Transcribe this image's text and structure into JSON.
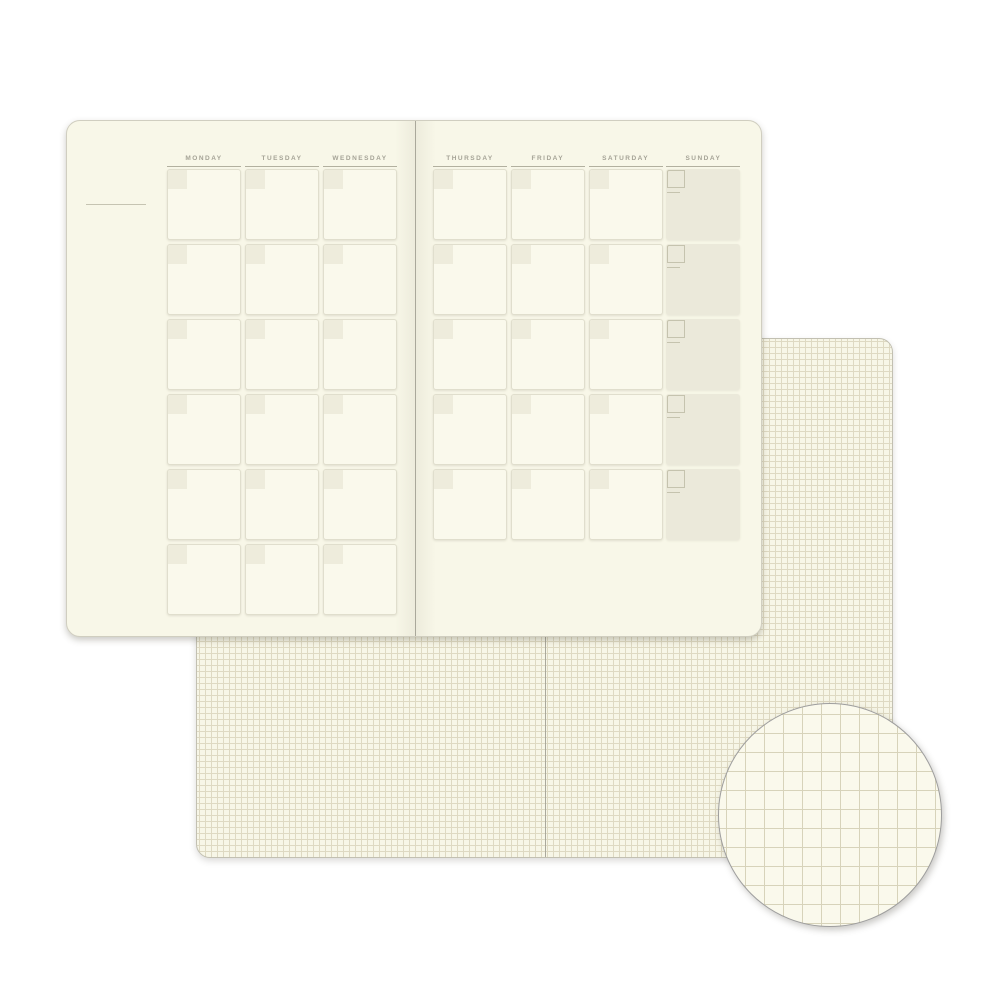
{
  "calendar": {
    "left_page": {
      "days": [
        "MONDAY",
        "TUESDAY",
        "WEDNESDAY"
      ],
      "rows": 6
    },
    "right_page": {
      "days": [
        "THURSDAY",
        "FRIDAY",
        "SATURDAY",
        "SUNDAY"
      ],
      "rows": 5,
      "shaded_day": "SUNDAY"
    }
  },
  "colors": {
    "calendar_page_bg": "#f8f7e8",
    "calendar_border": "#d0cec0",
    "cell_bg": "#faf9ec",
    "cell_border": "#e0decd",
    "date_box": "#eeecdc",
    "sunday_cell_bg": "#ebe9da",
    "sunday_box_line": "#c5c3ae",
    "header_text": "#a5a396",
    "header_underline": "#b2b09f",
    "month_line": "#c6c4b2",
    "spine_line": "#aaa89b",
    "grid_paper": "#f7f6e7",
    "grid_line": "#ded9c2",
    "grid_border": "#c2c0b2",
    "magnifier_paper": "#faf9ec",
    "magnifier_grid_line": "#d7d3ba",
    "magnifier_border": "#9e9e9e"
  }
}
